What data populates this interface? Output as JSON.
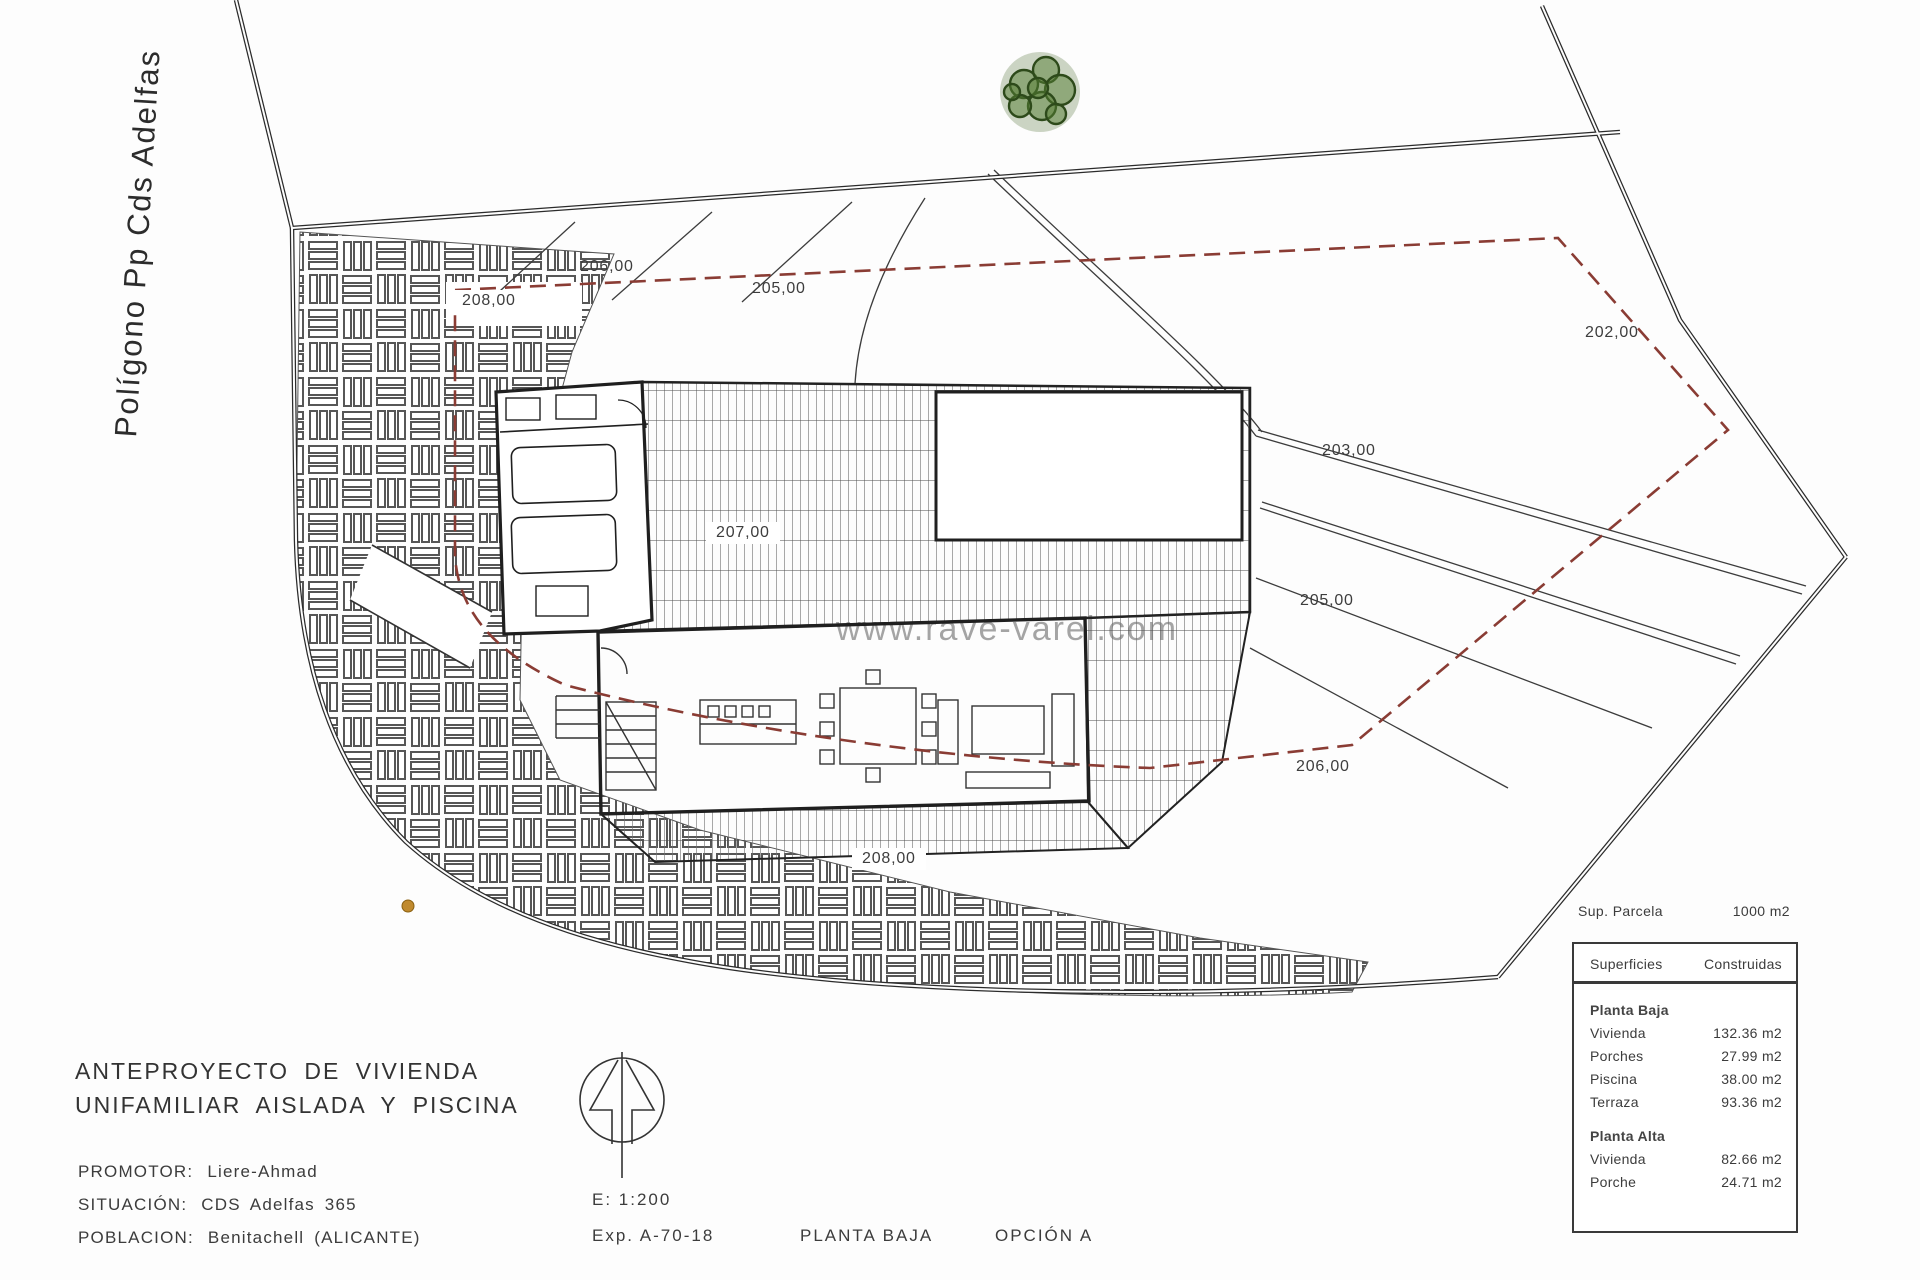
{
  "side_label": "Polígono Pp Cds Adelfas",
  "watermark": "www.rave-varel.com",
  "contours": {
    "c208_box": "208,00",
    "c206_top": "206,00",
    "c205_top": "205,00",
    "c202": "202,00",
    "c203": "203,00",
    "c207": "207,00",
    "c205_mid": "205,00",
    "c206_mid": "206,00",
    "c208_bottom": "208,00"
  },
  "title_block": {
    "line1": "ANTEPROYECTO DE VIVIENDA",
    "line2": "UNIFAMILIAR AISLADA Y PISCINA",
    "promotor_label": "PROMOTOR:",
    "promotor_value": "Liere-Ahmad",
    "situacion_label": "SITUACIÓN:",
    "situacion_value": "CDS Adelfas 365",
    "poblacion_label": "POBLACION:",
    "poblacion_value": "Benitachell (ALICANTE)",
    "scale": "E: 1:200",
    "exp": "Exp. A-70-18",
    "plan_name": "PLANTA BAJA",
    "option": "OPCIÓN A"
  },
  "areas_table": {
    "parcel_label": "Sup. Parcela",
    "parcel_value": "1000 m2",
    "col1": "Superficies",
    "col2": "Construidas",
    "sections": [
      {
        "name": "Planta Baja",
        "rows": [
          [
            "Vivienda",
            "132.36 m2"
          ],
          [
            "Porches",
            "27.99 m2"
          ],
          [
            "Piscina",
            "38.00 m2"
          ],
          [
            "Terraza",
            "93.36 m2"
          ]
        ]
      },
      {
        "name": "Planta Alta",
        "rows": [
          [
            "Vivienda",
            "82.66 m2"
          ],
          [
            "Porche",
            "24.71 m2"
          ]
        ]
      }
    ]
  },
  "colors": {
    "setback_red": "#8a3c34",
    "tree_green": "#3c5a22",
    "line_dark": "#2b2b2b"
  }
}
